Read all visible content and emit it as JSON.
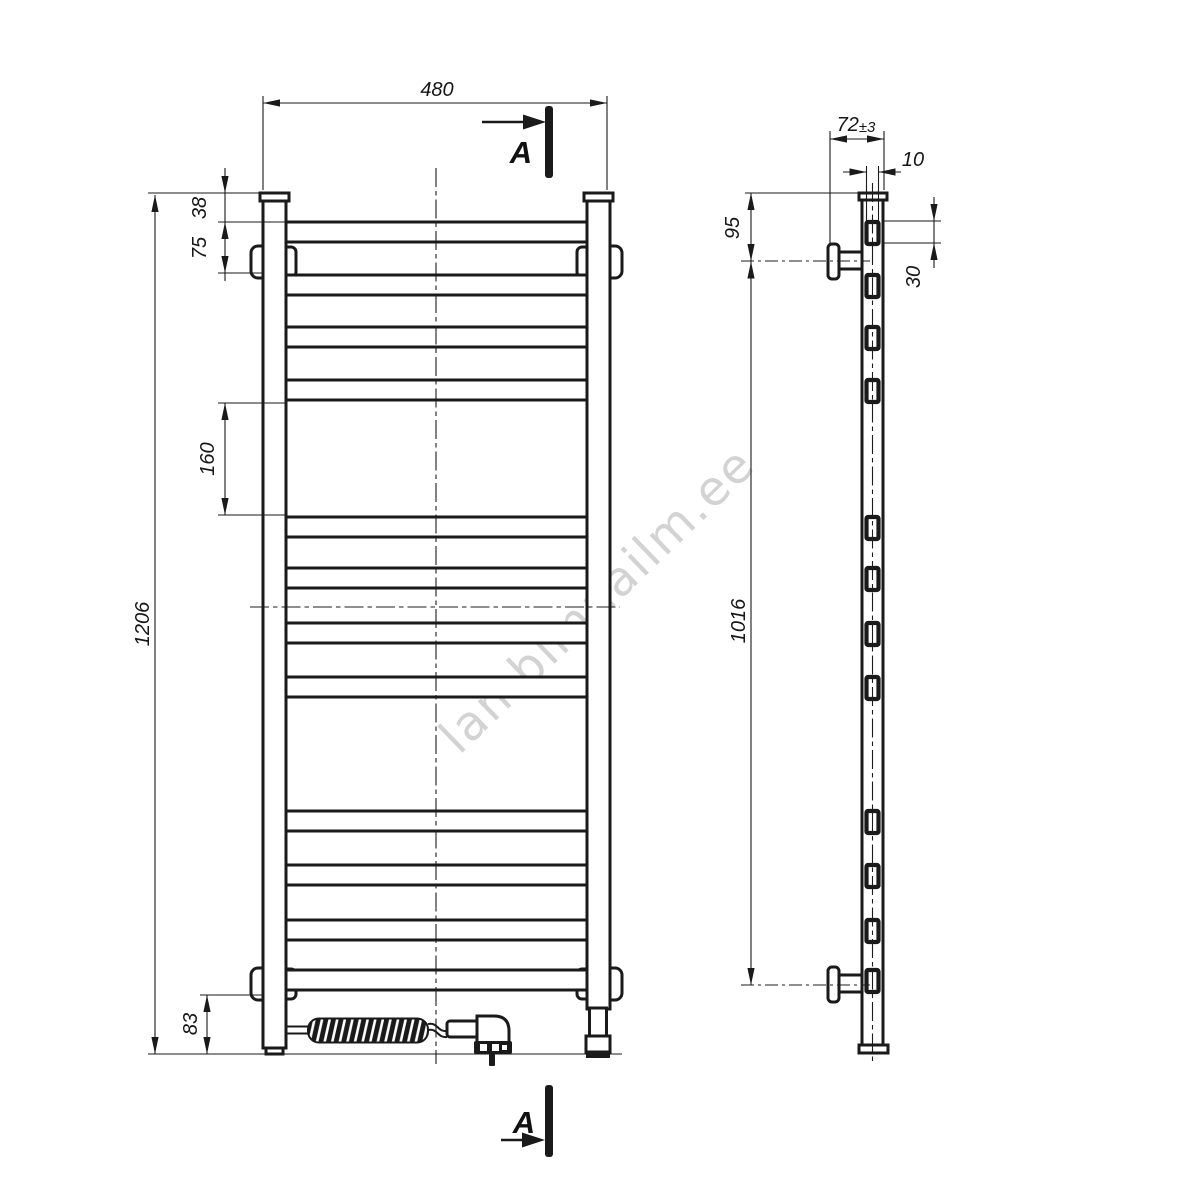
{
  "watermark": {
    "text": "lambimaailm.ee",
    "color": "#d3d3d3"
  },
  "section": {
    "label": "A"
  },
  "line_color": "#1a1a1a",
  "dims": {
    "overall_width": "480",
    "overall_height": "1206",
    "top_to_first_rung": "38",
    "first_rung_to_bracket": "75",
    "rung_group_gap": "160",
    "bottom_offset": "83",
    "wall_distance": "72",
    "wall_distance_tolerance": "±3",
    "rung_depth": "10",
    "rung_height": "30",
    "top_to_bracket": "95",
    "bracket_span": "1016"
  },
  "drawing_data": {
    "type": "technical-drawing",
    "views": [
      "front",
      "side"
    ],
    "rung_count": 12,
    "rung_y_positions": [
      222,
      275,
      327,
      380,
      517,
      568,
      623,
      677,
      811,
      865,
      920,
      970
    ],
    "front_rung_thickness_px": 20,
    "side_rung_thickness_px": 22,
    "dimension_values_mm": {
      "overall_width": 480,
      "overall_height": 1206,
      "top_to_first_rung": 38,
      "first_rung_to_bracket": 75,
      "rung_group_gap": 160,
      "bottom_offset": 83,
      "wall_distance": 72,
      "wall_tolerance": 3,
      "rung_depth": 10,
      "rung_height": 30,
      "top_to_bracket": 95,
      "bracket_span": 1016
    }
  }
}
